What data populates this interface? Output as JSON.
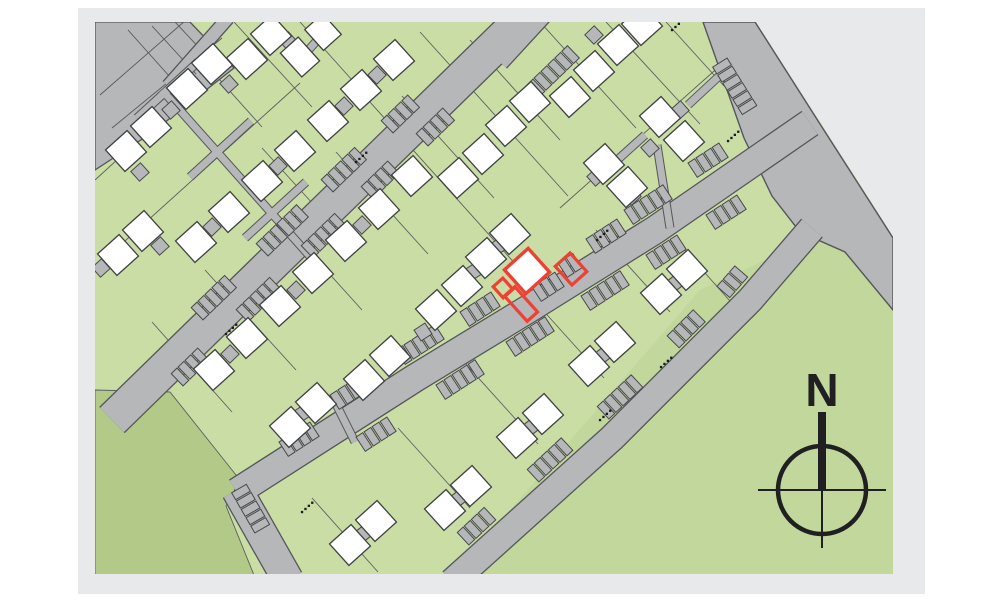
{
  "compass": {
    "label": "N"
  },
  "colors": {
    "page": "#ffffff",
    "panel": "#e8e9eb",
    "parcelGreen": "#c9dda4",
    "parkGreen": "#b2c987",
    "meadowGreen": "#c1d79b",
    "road": "#b6b7b9",
    "roadEdge": "#54565a",
    "parcelLine": "#5d5f61",
    "house": "#ffffff",
    "houseLine": "#3f4143",
    "unitLine": "#47494b",
    "highlight": "#ee4136",
    "compass": "#202022",
    "dot": "#1c1c1e"
  },
  "map": {
    "panel": {
      "x": 78,
      "y": 8,
      "w": 847,
      "h": 586
    },
    "frame": {
      "x": 95,
      "y": 22,
      "w": 798,
      "h": 552
    },
    "roads": [
      {
        "name": "main-street-west",
        "pts": [
          [
            540,
            2
          ],
          [
            112,
            420
          ]
        ],
        "w": 34
      },
      {
        "name": "main-street-central",
        "pts": [
          [
            810,
            123
          ],
          [
            655,
            230
          ],
          [
            530,
            308
          ],
          [
            415,
            378
          ],
          [
            237,
            492
          ]
        ],
        "w": 27
      },
      {
        "name": "street-stub-south",
        "pts": [
          [
            237,
            490
          ],
          [
            288,
            580
          ]
        ],
        "w": 30
      },
      {
        "name": "street-southeast",
        "pts": [
          [
            812,
            228
          ],
          [
            750,
            300
          ],
          [
            612,
            438
          ],
          [
            452,
            582
          ]
        ],
        "w": 26
      },
      {
        "name": "drive-north",
        "pts": [
          [
            548,
            14
          ],
          [
            502,
            64
          ]
        ],
        "w": 11
      },
      {
        "name": "drive-corner",
        "pts": [
          [
            228,
            18
          ],
          [
            168,
            86
          ]
        ],
        "w": 12
      }
    ],
    "boundaryRoad": [
      [
        703,
        22
      ],
      [
        755,
        22
      ],
      [
        820,
        124
      ],
      [
        893,
        238
      ],
      [
        893,
        310
      ],
      [
        845,
        252
      ],
      [
        800,
        232
      ],
      [
        772,
        196
      ],
      [
        744,
        138
      ]
    ],
    "carveNE": [
      [
        756,
        22
      ],
      [
        893,
        22
      ],
      [
        893,
        236
      ]
    ],
    "cornerLot": [
      [
        95,
        22
      ],
      [
        190,
        22
      ],
      [
        234,
        68
      ],
      [
        150,
        134
      ],
      [
        95,
        170
      ]
    ],
    "cornerGrid": [
      [
        128,
        30,
        170,
        77
      ],
      [
        152,
        26,
        196,
        74
      ],
      [
        175,
        22,
        218,
        68
      ],
      [
        100,
        95,
        186,
        20
      ],
      [
        112,
        128,
        222,
        38
      ]
    ],
    "parks": {
      "p1": [
        [
          95,
          390
        ],
        [
          170,
          392
        ],
        [
          240,
          480
        ],
        [
          226,
          506
        ],
        [
          258,
          585
        ],
        [
          95,
          585
        ]
      ],
      "p2": [
        [
          700,
          290
        ],
        [
          830,
          230
        ],
        [
          893,
          310
        ],
        [
          893,
          574
        ],
        [
          455,
          574
        ]
      ]
    },
    "parcelLines": [
      [
        168,
        22,
        262,
        127
      ],
      [
        234,
        22,
        312,
        107
      ],
      [
        300,
        22,
        352,
        80
      ],
      [
        95,
        268,
        300,
        83
      ],
      [
        95,
        180,
        208,
        77
      ],
      [
        352,
        82,
        536,
        287
      ],
      [
        420,
        32,
        568,
        196
      ],
      [
        470,
        40,
        560,
        140
      ],
      [
        262,
        148,
        344,
        238
      ],
      [
        205,
        270,
        296,
        370
      ],
      [
        270,
        208,
        362,
        310
      ],
      [
        336,
        152,
        428,
        254
      ],
      [
        402,
        96,
        494,
        198
      ],
      [
        152,
        322,
        232,
        412
      ],
      [
        540,
        22,
        636,
        128
      ],
      [
        606,
        22,
        700,
        124
      ],
      [
        666,
        22,
        724,
        86
      ],
      [
        560,
        208,
        740,
        48
      ],
      [
        398,
        428,
        470,
        508
      ],
      [
        464,
        362,
        538,
        444
      ],
      [
        530,
        296,
        604,
        378
      ],
      [
        596,
        230,
        670,
        312
      ],
      [
        673,
        237,
        746,
        319
      ],
      [
        312,
        498,
        378,
        572
      ]
    ],
    "corridors": [
      {
        "pts": [
          [
            162,
            90
          ],
          [
            315,
            262
          ]
        ],
        "w": 7
      },
      {
        "pts": [
          [
            137,
            118
          ],
          [
            198,
            62
          ]
        ],
        "w": 7
      },
      {
        "pts": [
          [
            190,
            177
          ],
          [
            251,
            121
          ]
        ],
        "w": 7
      },
      {
        "pts": [
          [
            245,
            238
          ],
          [
            306,
            182
          ]
        ],
        "w": 7
      },
      {
        "pts": [
          [
            304,
            55
          ],
          [
            330,
            26
          ]
        ],
        "w": 7
      },
      {
        "pts": [
          [
            333,
            398
          ],
          [
            355,
            442
          ]
        ],
        "w": 7
      },
      {
        "pts": [
          [
            657,
            145
          ],
          [
            670,
            228
          ]
        ],
        "w": 7
      },
      {
        "pts": [
          [
            645,
            135
          ],
          [
            604,
            172
          ]
        ],
        "w": 7
      },
      {
        "pts": [
          [
            688,
            105
          ],
          [
            730,
            66
          ]
        ],
        "w": 7
      }
    ],
    "stallSize": [
      8,
      17
    ],
    "stallPitch": 9.6,
    "stallGroups": [
      [
        200,
        311,
        5,
        -44
      ],
      [
        265,
        247,
        6,
        -44
      ],
      [
        330,
        183,
        5,
        -44
      ],
      [
        390,
        124,
        4,
        -44
      ],
      [
        536,
        88,
        6,
        -44
      ],
      [
        180,
        377,
        4,
        -44
      ],
      [
        245,
        313,
        5,
        -44
      ],
      [
        310,
        249,
        5,
        -44
      ],
      [
        370,
        190,
        4,
        -44
      ],
      [
        425,
        137,
        4,
        -44
      ],
      [
        287,
        447,
        4,
        -33
      ],
      [
        338,
        400,
        5,
        -33
      ],
      [
        404,
        355,
        5,
        -33
      ],
      [
        468,
        317,
        4,
        -33
      ],
      [
        540,
        292,
        3,
        -33
      ],
      [
        566,
        268,
        2,
        -33
      ],
      [
        594,
        244,
        4,
        -33
      ],
      [
        632,
        215,
        5,
        -33
      ],
      [
        696,
        168,
        4,
        -33
      ],
      [
        364,
        442,
        4,
        -33
      ],
      [
        444,
        390,
        5,
        -33
      ],
      [
        514,
        347,
        5,
        -33
      ],
      [
        589,
        301,
        5,
        -33
      ],
      [
        654,
        260,
        4,
        -33
      ],
      [
        714,
        220,
        4,
        -33
      ],
      [
        466,
        536,
        4,
        -43
      ],
      [
        536,
        473,
        5,
        -43
      ],
      [
        606,
        410,
        5,
        -43
      ],
      [
        676,
        339,
        4,
        -45
      ],
      [
        726,
        289,
        3,
        -49
      ],
      [
        241,
        492,
        5,
        60
      ],
      [
        722,
        66,
        6,
        58
      ]
    ],
    "garages": [
      [
        171,
        110
      ],
      [
        229,
        84
      ],
      [
        288,
        41
      ],
      [
        140,
        172
      ],
      [
        101,
        268
      ],
      [
        160,
        246
      ],
      [
        212,
        227,
        -44
      ],
      [
        278,
        166,
        -44
      ],
      [
        344,
        106,
        -44
      ],
      [
        377,
        75,
        -44
      ],
      [
        230,
        354,
        -44
      ],
      [
        296,
        290,
        -44
      ],
      [
        362,
        225,
        -44
      ],
      [
        303,
        413,
        -33
      ],
      [
        423,
        332,
        -33
      ],
      [
        473,
        272,
        -33
      ],
      [
        499,
        246,
        -33
      ],
      [
        680,
        110,
        -42
      ],
      [
        650,
        148,
        -42
      ],
      [
        632,
        196,
        -42
      ],
      [
        596,
        177,
        -42
      ],
      [
        594,
        35,
        -44
      ],
      [
        458,
        499,
        -38
      ],
      [
        530,
        428,
        -38
      ],
      [
        602,
        356,
        -38
      ],
      [
        674,
        284,
        -38
      ],
      [
        363,
        534,
        -38
      ]
    ],
    "houses": [
      [
        187,
        89
      ],
      [
        212,
        64
      ],
      [
        247,
        59
      ],
      [
        271,
        35
      ],
      [
        126,
        151
      ],
      [
        151,
        127
      ],
      [
        118,
        255
      ],
      [
        143,
        231
      ],
      [
        300,
        57,
        24,
        32
      ],
      [
        323,
        32,
        24,
        28
      ],
      [
        196,
        242
      ],
      [
        229,
        212
      ],
      [
        262,
        181
      ],
      [
        295,
        151
      ],
      [
        328,
        121
      ],
      [
        361,
        90
      ],
      [
        394,
        60
      ],
      [
        214,
        370
      ],
      [
        247,
        338
      ],
      [
        280,
        306
      ],
      [
        313,
        273
      ],
      [
        346,
        241
      ],
      [
        379,
        209
      ],
      [
        412,
        176
      ],
      [
        458,
        178
      ],
      [
        483,
        154
      ],
      [
        506,
        126
      ],
      [
        530,
        102
      ],
      [
        290,
        427
      ],
      [
        316,
        403
      ],
      [
        364,
        380
      ],
      [
        390,
        356
      ],
      [
        436,
        310
      ],
      [
        462,
        286
      ],
      [
        486,
        258
      ],
      [
        510,
        234
      ],
      [
        570,
        97
      ],
      [
        594,
        71
      ],
      [
        618,
        45
      ],
      [
        642,
        25
      ],
      [
        660,
        117
      ],
      [
        684,
        141
      ],
      [
        604,
        164
      ],
      [
        627,
        187
      ],
      [
        445,
        510
      ],
      [
        471,
        486
      ],
      [
        517,
        438
      ],
      [
        543,
        414
      ],
      [
        589,
        366
      ],
      [
        615,
        342
      ],
      [
        661,
        294
      ],
      [
        687,
        270
      ],
      [
        350,
        545
      ],
      [
        376,
        521
      ]
    ],
    "dots": [
      [
        597,
        240
      ],
      [
        528,
        286
      ],
      [
        728,
        141
      ],
      [
        302,
        512
      ],
      [
        226,
        334
      ],
      [
        356,
        162
      ],
      [
        600,
        420
      ],
      [
        661,
        367
      ],
      [
        672,
        30
      ]
    ],
    "highlight": {
      "house": [
        527,
        271,
        32,
        32
      ],
      "garden": [
        521,
        304,
        14,
        34
      ],
      "notch": [
        503,
        288,
        13,
        15
      ],
      "annex": [
        571,
        269,
        20,
        25
      ]
    },
    "compassGeom": {
      "cx": 822,
      "cy": 490,
      "r": 44,
      "needleW": 8,
      "needleTop": 412,
      "hx1": 758,
      "hx2": 886,
      "vy2": 548,
      "labelX": 822,
      "labelY": 406
    }
  }
}
